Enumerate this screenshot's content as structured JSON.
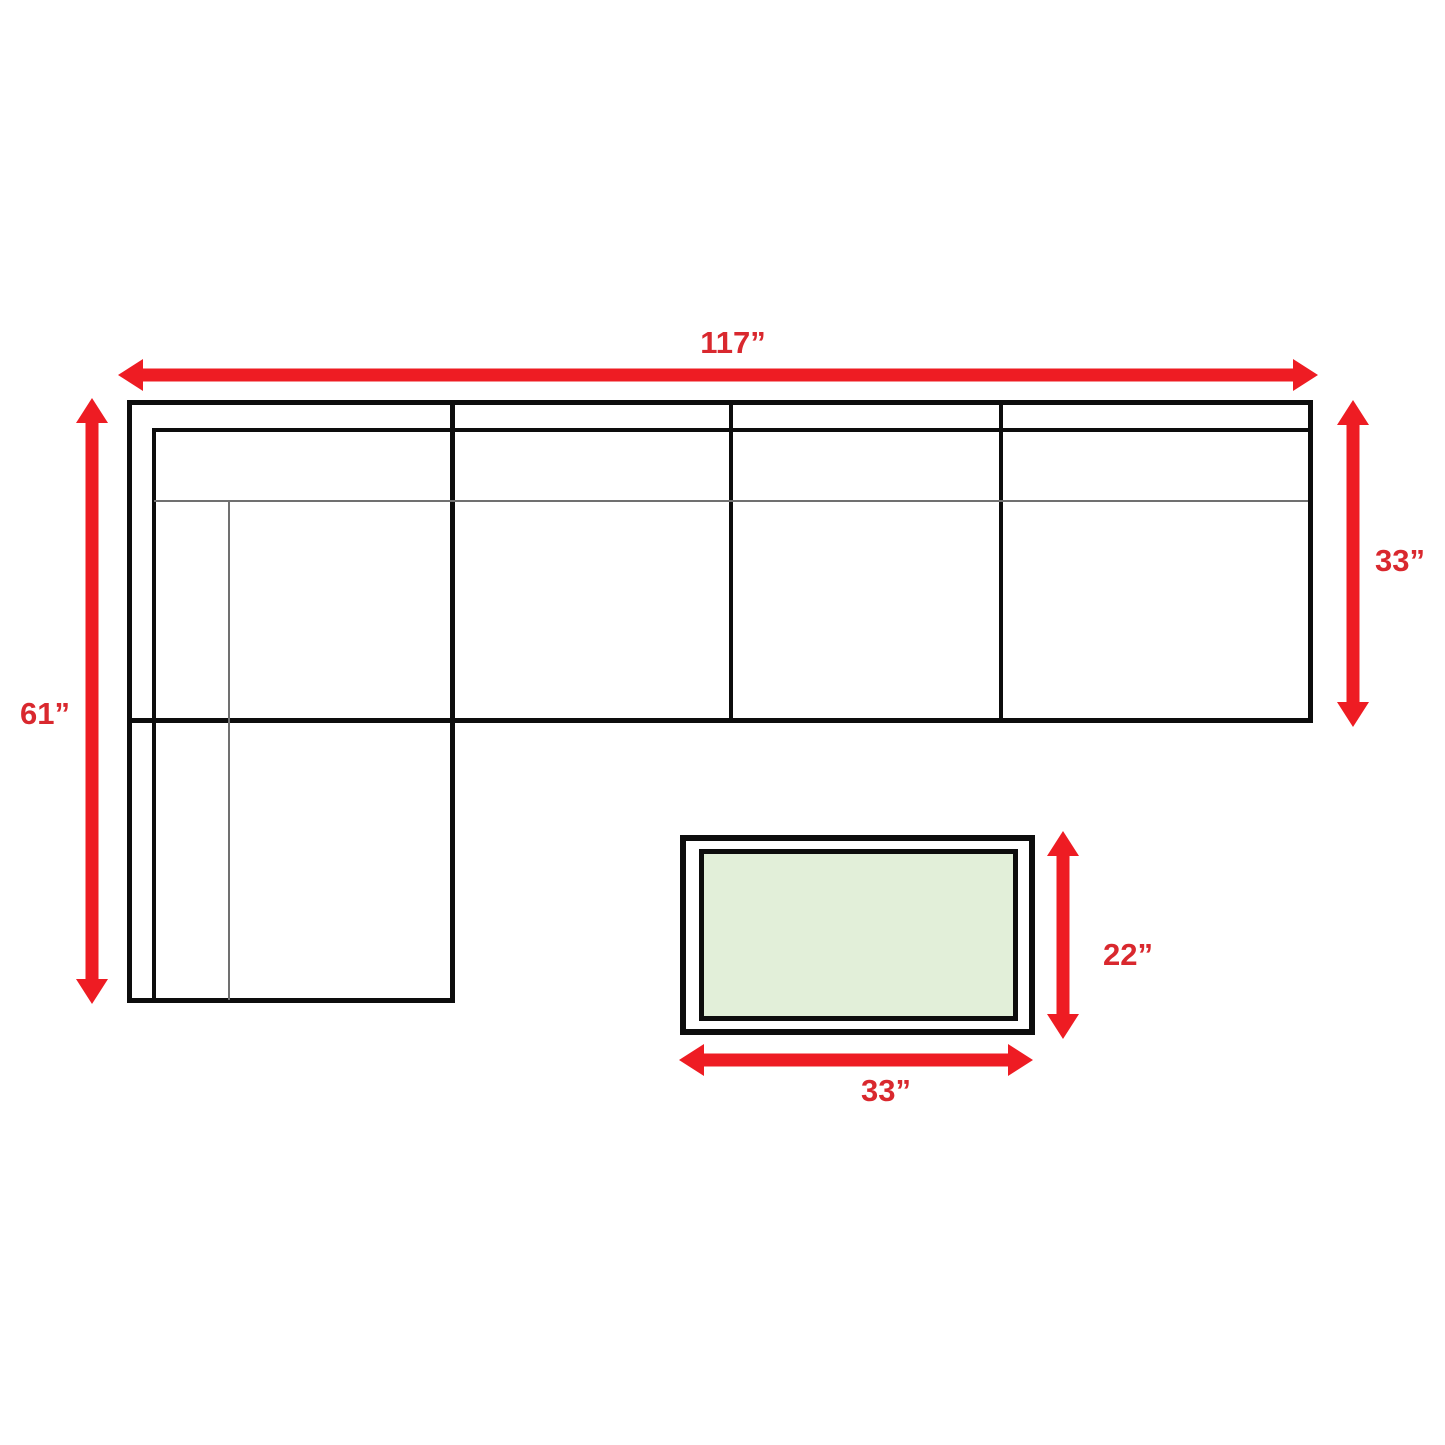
{
  "page": {
    "background": "#ffffff",
    "description_labels_units": "inches"
  },
  "colors": {
    "arrow_red": "#ee1c23",
    "label_red": "#d9282e",
    "line_black": "#0d0d0d",
    "thin_line_gray": "#707070",
    "table_fill_green": "#e2efd9"
  },
  "labels": {
    "sofa_width": "117”",
    "sofa_height": "61”",
    "sofa_depth": "33”",
    "table_height": "22”",
    "table_width": "33”"
  }
}
